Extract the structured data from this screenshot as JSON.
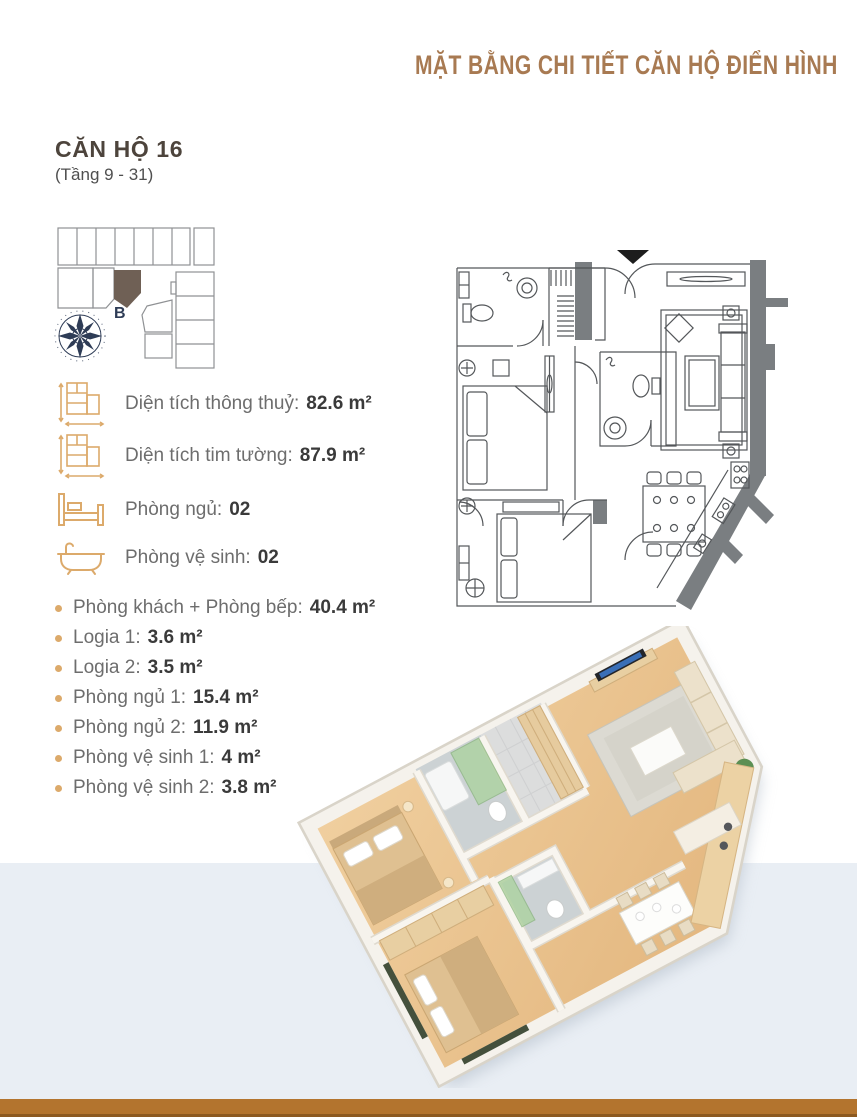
{
  "page": {
    "title": "MẶT BẰNG CHI TIẾT CĂN HỘ ĐIỂN HÌNH"
  },
  "colors": {
    "title_brown": "#a87a52",
    "accent_gold": "#dcaa6b",
    "footer_brown": "#b3742e",
    "band_gray": "#e9eef4",
    "compass_navy": "#2e3c56",
    "highlighted_unit_brown": "#6f6055",
    "label_gray": "#6d6d6d",
    "value_dark": "#3a3a3a"
  },
  "apartment": {
    "name": "CĂN HỘ 16",
    "floors": "(Tầng 9 - 31)",
    "compass_label": "B",
    "specs": [
      {
        "icon": "floor-area-icon",
        "label": "Diện tích thông thuỷ:",
        "value": "82.6 m²"
      },
      {
        "icon": "floor-area-icon",
        "label": "Diện tích tim tường:",
        "value": "87.9 m²"
      },
      {
        "icon": "bed-icon",
        "label": "Phòng ngủ:",
        "value": "02"
      },
      {
        "icon": "bathtub-icon",
        "label": "Phòng vệ sinh:",
        "value": "02"
      }
    ],
    "rooms": [
      {
        "label": "Phòng khách + Phòng bếp:",
        "value": "40.4 m²"
      },
      {
        "label": "Logia 1:",
        "value": "3.6 m²"
      },
      {
        "label": "Logia 2:",
        "value": "3.5 m²"
      },
      {
        "label": "Phòng ngủ 1:",
        "value": "15.4 m²"
      },
      {
        "label": "Phòng ngủ 2:",
        "value": "11.9 m²"
      },
      {
        "label": "Phòng vệ sinh 1:",
        "value": "4 m²"
      },
      {
        "label": "Phòng vệ sinh 2:",
        "value": "3.8 m²"
      }
    ]
  }
}
